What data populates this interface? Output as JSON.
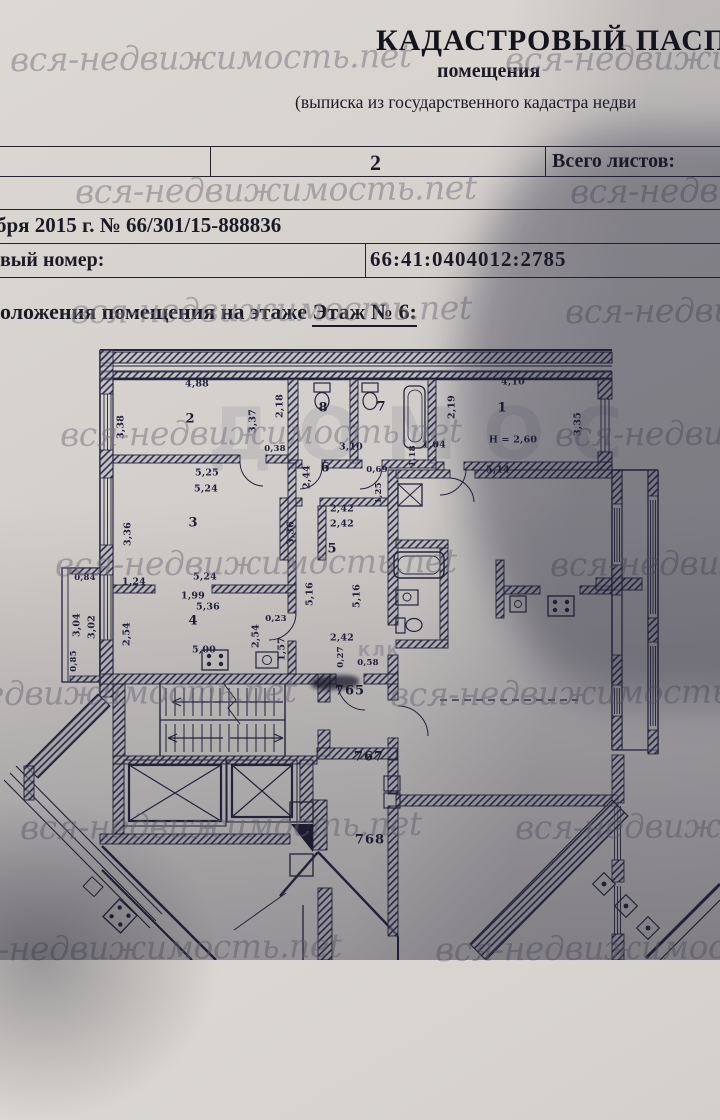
{
  "header": {
    "title": "КАДАСТРОВЫЙ ПАСПОРТ",
    "subtitle": "помещения",
    "note": "(выписка из государственного кадастра недви"
  },
  "sheet_table": {
    "page_number": "2",
    "total_label": "Всего листов:"
  },
  "meta": {
    "date_line": "бря 2015 г. № 66/301/15-888836",
    "cad_label": "вый номер:",
    "cad_value": "66:41:0404012:2785"
  },
  "floor_line": {
    "prefix": "оложения помещения на этаже ",
    "value": "Этаж № 6:"
  },
  "ghost": {
    "big": "ДОМОС",
    "small": "КЛК"
  },
  "photo": {
    "watermark_text": "вся-недвижимость.net",
    "watermark_rows": [
      {
        "y": 38,
        "x": 10
      },
      {
        "y": 170,
        "x": 75
      },
      {
        "y": 290,
        "x": 70
      },
      {
        "y": 413,
        "x": 60
      },
      {
        "y": 543,
        "x": 55
      },
      {
        "y": 673,
        "x": -105
      },
      {
        "y": 806,
        "x": 20
      },
      {
        "y": 928,
        "x": -60
      }
    ]
  },
  "plan": {
    "height_note": "Н = 2,60",
    "room_labels": [
      {
        "n": "1",
        "x": 502,
        "y": 408
      },
      {
        "n": "2",
        "x": 190,
        "y": 419
      },
      {
        "n": "3",
        "x": 193,
        "y": 523
      },
      {
        "n": "4",
        "x": 193,
        "y": 621
      },
      {
        "n": "5",
        "x": 332,
        "y": 549
      },
      {
        "n": "6",
        "x": 325,
        "y": 468
      },
      {
        "n": "7",
        "x": 381,
        "y": 407
      },
      {
        "n": "8",
        "x": 323,
        "y": 408
      }
    ],
    "unit_labels": [
      {
        "t": "765",
        "x": 350,
        "y": 691,
        "crossed": true
      },
      {
        "t": "767",
        "x": 369,
        "y": 757
      },
      {
        "t": "768",
        "x": 370,
        "y": 840
      }
    ],
    "dims": [
      {
        "t": "4,88",
        "x": 197,
        "y": 384
      },
      {
        "t": "3,38",
        "x": 121,
        "y": 427,
        "v": 1
      },
      {
        "t": "3,37",
        "x": 253,
        "y": 421,
        "v": 1
      },
      {
        "t": "2,18",
        "x": 280,
        "y": 406,
        "v": 1
      },
      {
        "t": "2,19",
        "x": 452,
        "y": 407,
        "v": 1
      },
      {
        "t": "4,10",
        "x": 513,
        "y": 382
      },
      {
        "t": "3,35",
        "x": 578,
        "y": 424,
        "v": 1
      },
      {
        "t": "Н = 2,60",
        "x": 513,
        "y": 440
      },
      {
        "t": "5,14",
        "x": 498,
        "y": 470
      },
      {
        "t": "0,38",
        "x": 275,
        "y": 449,
        "s": 1
      },
      {
        "t": "3,10",
        "x": 351,
        "y": 447
      },
      {
        "t": "1,04",
        "x": 434,
        "y": 445
      },
      {
        "t": "0,69",
        "x": 377,
        "y": 470,
        "s": 1
      },
      {
        "t": "2,44",
        "x": 307,
        "y": 477,
        "v": 1
      },
      {
        "t": "1,18",
        "x": 413,
        "y": 456,
        "v": 1,
        "s": 1
      },
      {
        "t": "1,25",
        "x": 379,
        "y": 493,
        "v": 1,
        "s": 1
      },
      {
        "t": "5,25",
        "x": 207,
        "y": 473
      },
      {
        "t": "5,24",
        "x": 206,
        "y": 489
      },
      {
        "t": "2,42",
        "x": 342,
        "y": 509
      },
      {
        "t": "2,42",
        "x": 342,
        "y": 524
      },
      {
        "t": "3,36",
        "x": 128,
        "y": 534,
        "v": 1
      },
      {
        "t": "3,36",
        "x": 291,
        "y": 533,
        "v": 1
      },
      {
        "t": "5,16",
        "x": 310,
        "y": 594,
        "v": 1
      },
      {
        "t": "5,16",
        "x": 357,
        "y": 596,
        "v": 1
      },
      {
        "t": "1,24",
        "x": 134,
        "y": 582
      },
      {
        "t": "5,24",
        "x": 205,
        "y": 577
      },
      {
        "t": "1,99",
        "x": 193,
        "y": 596
      },
      {
        "t": "5,36",
        "x": 208,
        "y": 607
      },
      {
        "t": "0,84",
        "x": 85,
        "y": 578,
        "s": 1
      },
      {
        "t": "3,04",
        "x": 77,
        "y": 625,
        "v": 1
      },
      {
        "t": "3,02",
        "x": 92,
        "y": 627,
        "v": 1
      },
      {
        "t": "2,54",
        "x": 127,
        "y": 634,
        "v": 1
      },
      {
        "t": "0,23",
        "x": 276,
        "y": 619,
        "s": 1
      },
      {
        "t": "2,54",
        "x": 256,
        "y": 636,
        "v": 1
      },
      {
        "t": "1,57",
        "x": 282,
        "y": 649,
        "v": 1
      },
      {
        "t": "5,00",
        "x": 204,
        "y": 650
      },
      {
        "t": "2,42",
        "x": 342,
        "y": 638
      },
      {
        "t": "0,27",
        "x": 341,
        "y": 657,
        "v": 1,
        "s": 1
      },
      {
        "t": "0,58",
        "x": 368,
        "y": 663,
        "s": 1
      },
      {
        "t": "0,85",
        "x": 74,
        "y": 661,
        "v": 1,
        "s": 1
      }
    ]
  }
}
